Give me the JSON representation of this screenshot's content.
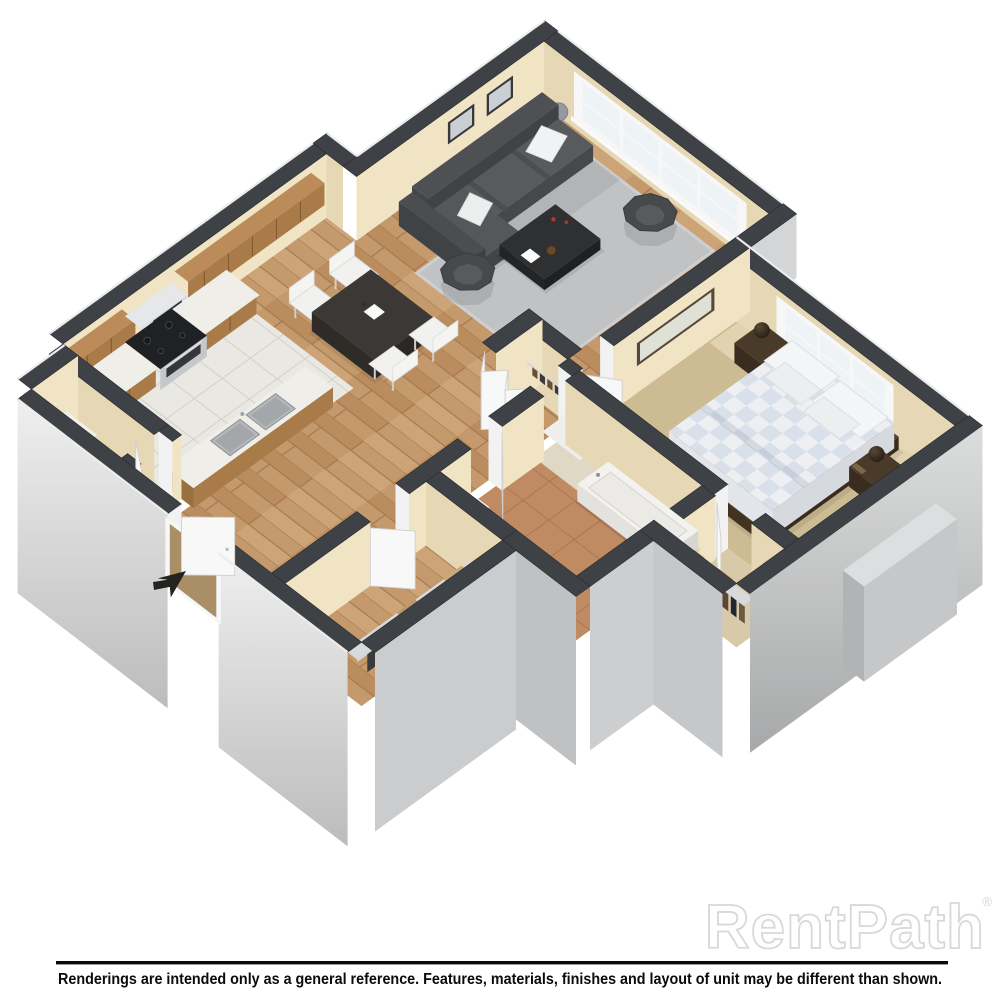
{
  "watermark": {
    "text": "RentPath",
    "registered": "®",
    "color": "#dadada"
  },
  "footer": {
    "disclaimer": "Renderings are intended only as a general reference. Features, materials, finishes and layout of unit may be different than shown.",
    "rule_color": "#0b0b0b"
  },
  "icons": {
    "entry_arrow": "northeast-cursor-arrow"
  },
  "floorplan": {
    "palette": {
      "wall_top": "#3e4145",
      "wall_edge": "#2b2e31",
      "cream_front": "#e6d8b5",
      "cream_right": "#f0e4c4",
      "ext_gray": "#cfd0d1",
      "skirt_light": "#ececec",
      "skirt_dark": "#b9babc",
      "wood": "#c49a6d",
      "tile": "#eae8e2",
      "terracotta": "#c08a63",
      "carpet": "#cdbb93",
      "counter": "#f0eee8",
      "cabinet_wood": "#a97b49",
      "sofa_gray": "#55575b",
      "rug_gray": "#c0c2c4",
      "accent_red": "#b2372e",
      "bed_white": "#edeff2"
    }
  }
}
